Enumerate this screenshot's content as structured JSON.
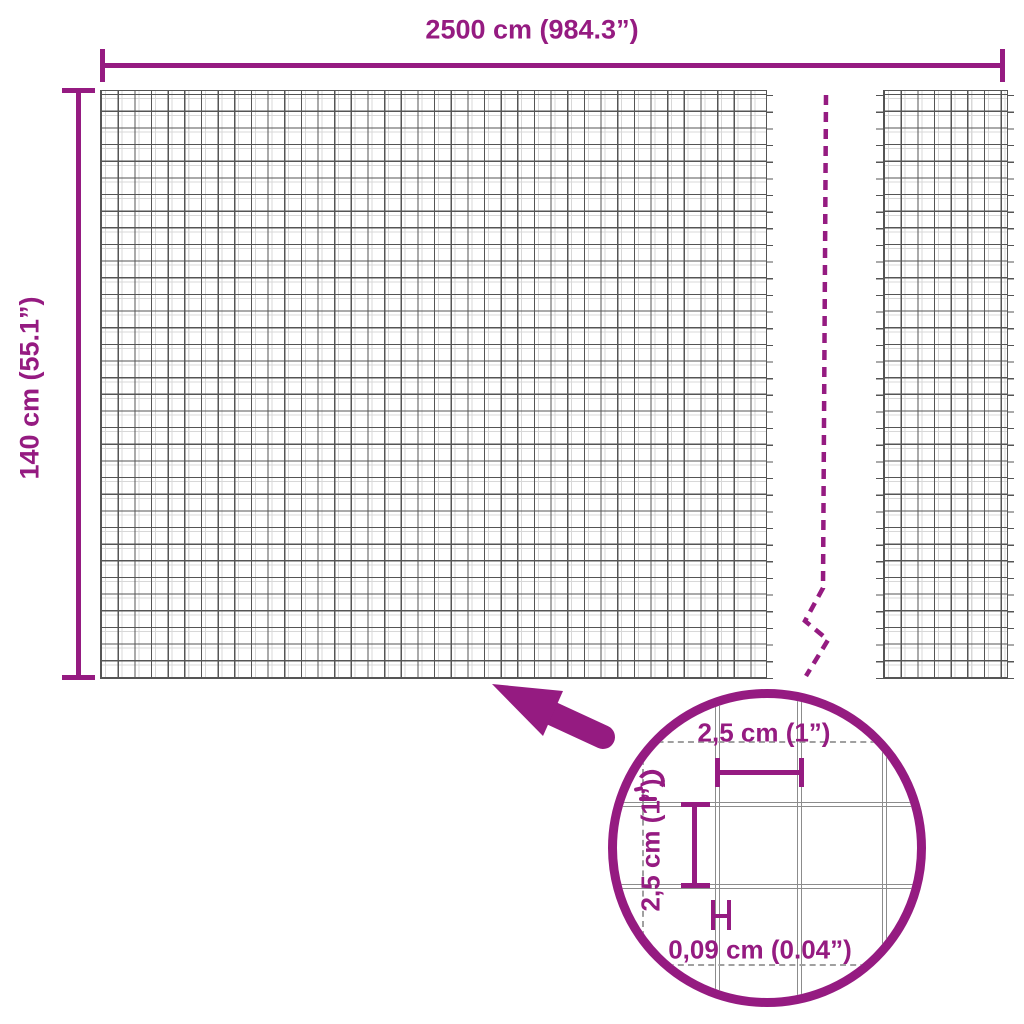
{
  "diagram": {
    "title": "wire-mesh-panel-dimensions",
    "width_dimension": {
      "label": "2500 cm (984.3”)"
    },
    "height_dimension": {
      "label": "140 cm (55.1”)"
    },
    "detail": {
      "cell_width": {
        "label": "2,5 cm (1”)"
      },
      "cell_height": {
        "label": "2,5 cm (1”)"
      },
      "wire_thickness": {
        "label": "0,09 cm (0.04”)"
      }
    },
    "icons": {
      "zoom_arrow": "arrow-pointing-up-left",
      "magnifier": "detail-circle",
      "break_line": "dashed-vertical-break"
    },
    "colors": {
      "accent": "#951b81",
      "mesh_line_dark": "#555555",
      "mesh_line_light": "#d8d8d8",
      "detail_wire": "#8c8c8c"
    }
  }
}
